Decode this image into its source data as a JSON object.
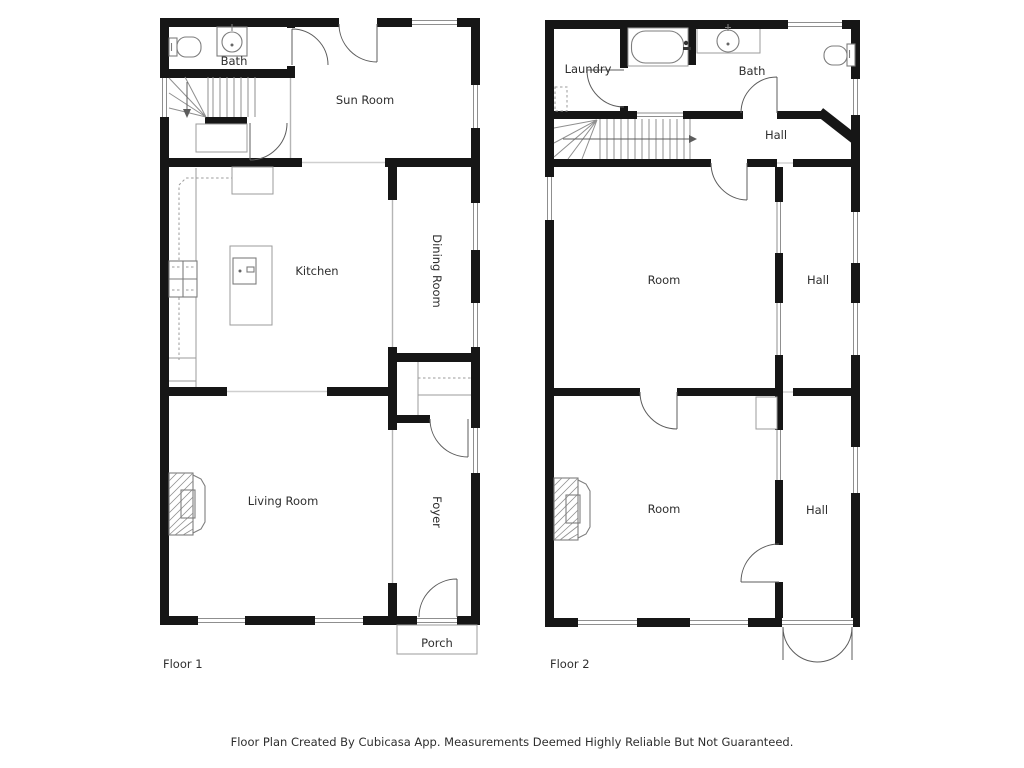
{
  "page": {
    "background": "#ffffff"
  },
  "colors": {
    "wall": "#161616",
    "fixture_line": "#7d7d7d",
    "light_line": "#9b9b9b",
    "door_line": "#5c5c5c",
    "text": "#2e2e2e"
  },
  "floor1": {
    "name": "Floor 1",
    "rooms": {
      "bath": "Bath",
      "sun_room": "Sun Room",
      "kitchen": "Kitchen",
      "dining_room": "Dining Room",
      "living_room": "Living Room",
      "foyer": "Foyer",
      "porch": "Porch"
    },
    "fixtures": [
      "toilet",
      "sink",
      "stairs",
      "under-stair-closet",
      "stove",
      "refrigerator",
      "kitchen-island-sink",
      "closet-shelves",
      "fireplace"
    ]
  },
  "floor2": {
    "name": "Floor 2",
    "rooms": {
      "laundry": "Laundry",
      "bath": "Bath",
      "hall_top": "Hall",
      "room_mid": "Room",
      "hall_mid": "Hall",
      "room_bottom": "Room",
      "hall_bottom": "Hall"
    },
    "fixtures": [
      "washer-space-dashed",
      "bathtub",
      "sink",
      "toilet",
      "stairs",
      "closet",
      "fireplace",
      "french-doors"
    ]
  },
  "footer": {
    "disclaimer": "Floor Plan Created By Cubicasa App. Measurements Deemed Highly Reliable But Not Guaranteed."
  }
}
